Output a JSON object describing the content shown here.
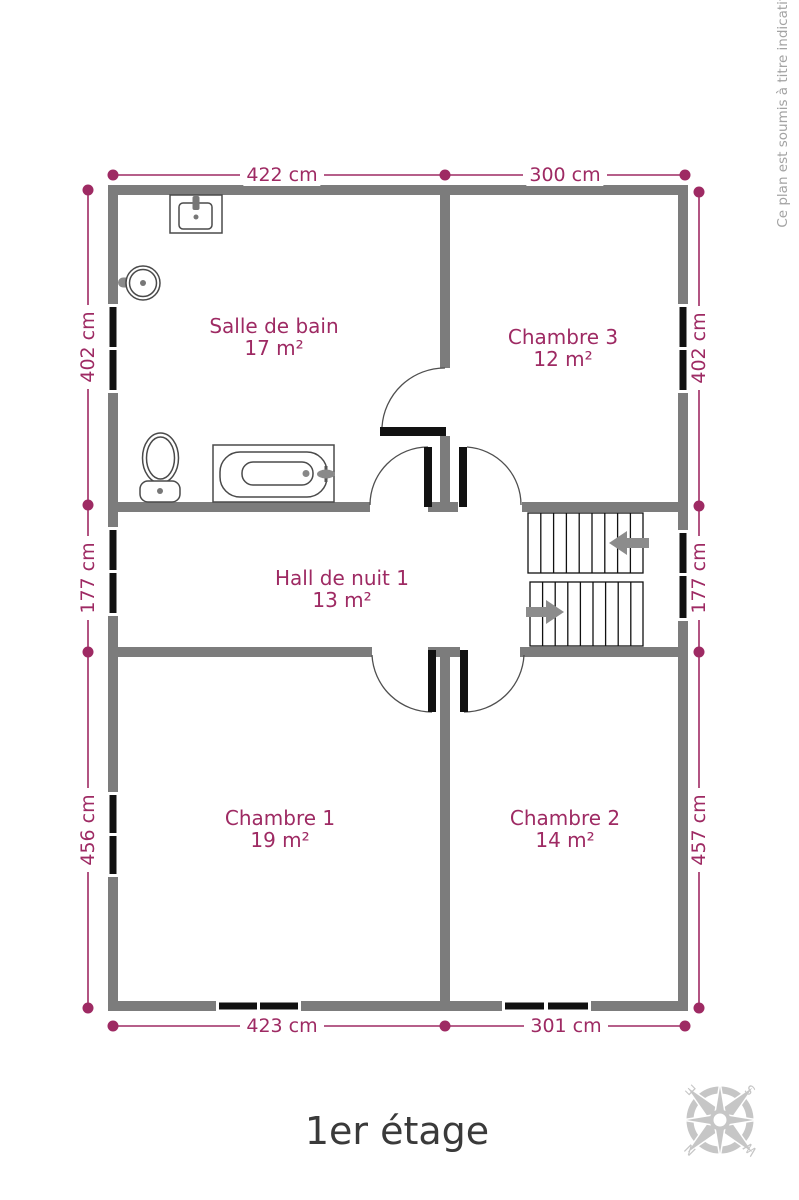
{
  "page": {
    "title": "1er étage",
    "disclaimer": "Ce plan est soumis à titre indicatif"
  },
  "colors": {
    "accent": "#9E2A63",
    "wall": "#7C7C7C",
    "window": "#111111",
    "door_leaf": "#111111",
    "stairs_arrow": "#8C8C8C",
    "fixture_outline": "#4A4A4A",
    "compass": "#C6C6C6",
    "title_text": "#3A3A3A",
    "disclaimer_text": "#A3A3A3"
  },
  "rooms": [
    {
      "name": "Salle de bain",
      "area": "17 m²"
    },
    {
      "name": "Chambre 3",
      "area": "12 m²"
    },
    {
      "name": "Hall de nuit 1",
      "area": "13 m²"
    },
    {
      "name": "Chambre 1",
      "area": "19 m²"
    },
    {
      "name": "Chambre 2",
      "area": "14 m²"
    }
  ],
  "dimensions": {
    "top": [
      {
        "label": "422 cm"
      },
      {
        "label": "300 cm"
      }
    ],
    "bottom": [
      {
        "label": "423 cm"
      },
      {
        "label": "301 cm"
      }
    ],
    "left": [
      {
        "label": "402 cm"
      },
      {
        "label": "177 cm"
      },
      {
        "label": "456 cm"
      }
    ],
    "right": [
      {
        "label": "402 cm"
      },
      {
        "label": "177 cm"
      },
      {
        "label": "457 cm"
      }
    ]
  },
  "compass": {
    "n": "N",
    "e": "E",
    "s": "S",
    "w": "W"
  }
}
